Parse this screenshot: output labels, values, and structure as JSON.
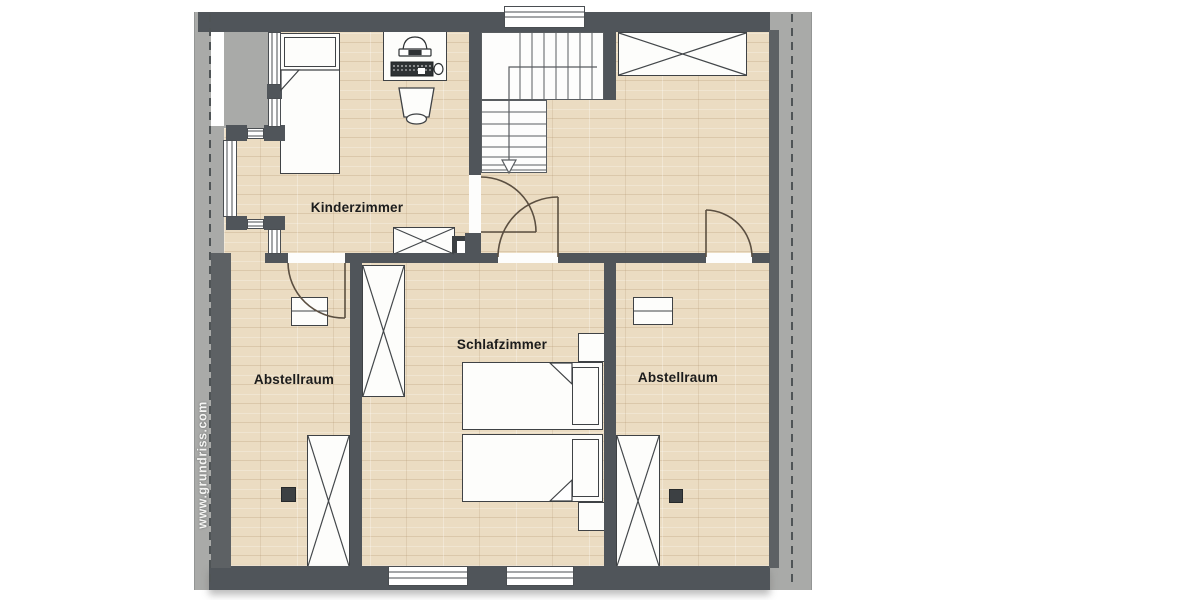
{
  "floorplan": {
    "watermark": "www.grundriss.com",
    "rooms": [
      {
        "id": "kinderzimmer",
        "label": "Kinderzimmer"
      },
      {
        "id": "schlafzimmer",
        "label": "Schlafzimmer"
      },
      {
        "id": "abstellraum-left",
        "label": "Abstellraum"
      },
      {
        "id": "abstellraum-right",
        "label": "Abstellraum"
      }
    ],
    "symbols": {
      "staircase": "l-shaped-stairs-with-down-arrow",
      "doors": 4,
      "windows": {
        "top_wall": 1,
        "bottom_wall": 2,
        "left_dormer_bay": "wrap-around-glazing"
      },
      "x_marked_wardrobes": 5,
      "beds": {
        "kinderzimmer": "single-bed",
        "schlafzimmer": "double-bed"
      },
      "desk": "desk-with-monitor-keyboard-mouse",
      "chairs": 1,
      "nightstands": 2,
      "cabinets": 2,
      "chimney_squares": 3
    },
    "colors": {
      "wall": "#50555a",
      "roof_band": "#a9aaa8",
      "floor": "#ebdcc2",
      "stair_fill": "#fdfdfc",
      "furniture_outline": "#3f4245",
      "door_arc": "#5b4f41",
      "label_text": "#1c1c1c",
      "watermark_text": "#f5f5f3"
    }
  }
}
